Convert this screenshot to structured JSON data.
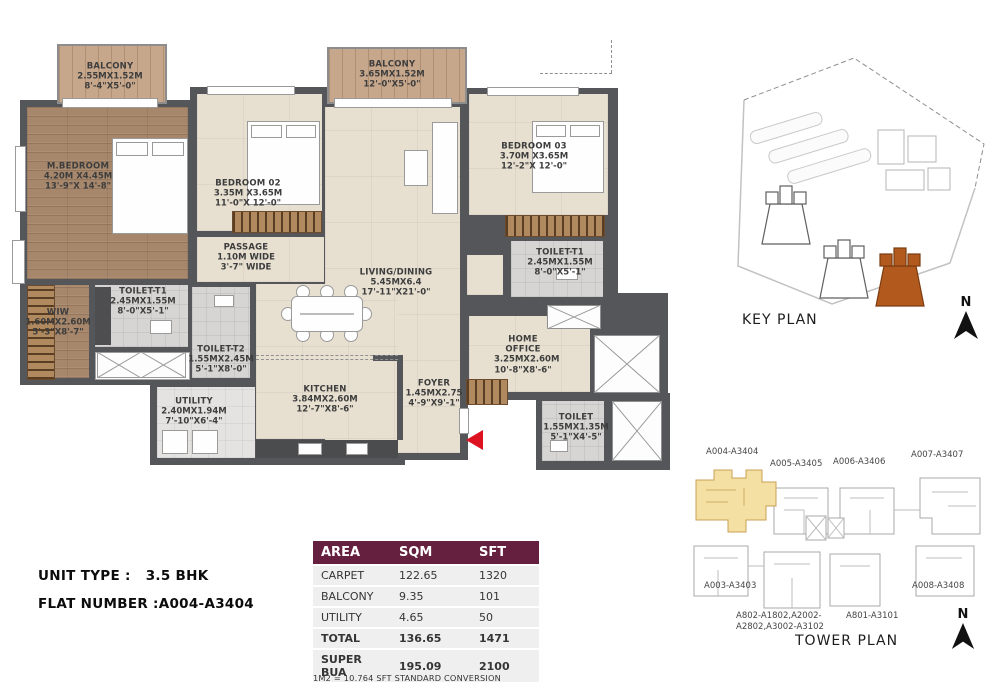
{
  "plan": {
    "rooms": {
      "balcony1": {
        "name": "BALCONY",
        "m": "2.55MX1.52M",
        "ft": "8'-4\"X5'-0\""
      },
      "mbedroom": {
        "name": "M.BEDROOM",
        "m": "4.20M X4.45M",
        "ft": "13'-9\"X 14'-8\""
      },
      "bedroom02": {
        "name": "BEDROOM 02",
        "m": "3.35M X3.65M",
        "ft": "11'-0\"X 12'-0\""
      },
      "passage": {
        "name": "PASSAGE",
        "m": "1.10M WIDE",
        "ft": "3'-7\" WIDE"
      },
      "toilet_t1a": {
        "name": "TOILET-T1",
        "m": "2.45MX1.55M",
        "ft": "8'-0\"X5'-1\""
      },
      "wiw": {
        "name": "WIW",
        "m": "1.60MX2.60M",
        "ft": "5'-3\"X8'-7\""
      },
      "toilet_t2": {
        "name": "TOILET-T2",
        "m": "1.55MX2.45M",
        "ft": "5'-1\"X8'-0\""
      },
      "utility": {
        "name": "UTILITY",
        "m": "2.40MX1.94M",
        "ft": "7'-10\"X6'-4\""
      },
      "kitchen": {
        "name": "KITCHEN",
        "m": "3.84MX2.60M",
        "ft": "12'-7\"X8'-6\""
      },
      "living": {
        "name": "LIVING/DINING",
        "m": "5.45MX6.4",
        "ft": "17'-11\"X21'-0\""
      },
      "balcony2": {
        "name": "BALCONY",
        "m": "3.65MX1.52M",
        "ft": "12'-0\"X5'-0\""
      },
      "bedroom03": {
        "name": "BEDROOM 03",
        "m": "3.70M X3.65M",
        "ft": "12'-2\"X 12'-0\""
      },
      "toilet_t1b": {
        "name": "TOILET-T1",
        "m": "2.45MX1.55M",
        "ft": "8'-0\"X5'-1\""
      },
      "home_office": {
        "name": "HOME OFFICE",
        "m": "3.25MX2.60M",
        "ft": "10'-8\"X8'-6\""
      },
      "foyer": {
        "name": "FOYER",
        "m": "1.45MX2.75",
        "ft": "4'-9\"X9'-1\""
      },
      "toilet": {
        "name": "TOILET",
        "m": "1.55MX1.35M",
        "ft": "5'-1\"X4'-5\""
      }
    }
  },
  "key_plan": {
    "label": "KEY PLAN",
    "north": "N"
  },
  "tower_plan": {
    "label": "TOWER PLAN",
    "north": "N",
    "units": {
      "a004": "A004-A3404",
      "a005": "A005-A3405",
      "a006": "A006-A3406",
      "a007": "A007-A3407",
      "a003": "A003-A3403",
      "a008": "A008-A3408",
      "a802_line1": "A802-A1802,A2002-",
      "a802_line2": "A2802,A3002-A3102",
      "a801": "A801-A3101"
    }
  },
  "info": {
    "unit_type_label": "UNIT TYPE :",
    "unit_type_value": "3.5 BHK",
    "flat_label": "FLAT NUMBER :",
    "flat_value": "A004-A3404"
  },
  "table": {
    "headers": [
      "AREA",
      "SQM",
      "SFT"
    ],
    "rows": [
      [
        "CARPET",
        "122.65",
        "1320"
      ],
      [
        "BALCONY",
        "9.35",
        "101"
      ],
      [
        "UTILITY",
        "4.65",
        "50"
      ],
      [
        "TOTAL",
        "136.65",
        "1471"
      ],
      [
        "SUPER BUA",
        "195.09",
        "2100"
      ]
    ],
    "note": "1M2 = 10.764 SFT STANDARD CONVERSION"
  },
  "colors": {
    "wall": "#55565a",
    "table_header": "#651f3f",
    "key_plan_highlight": "#b2591d",
    "tower_plan_highlight": "#f5e0a3",
    "entry_arrow": "#dd1220"
  }
}
